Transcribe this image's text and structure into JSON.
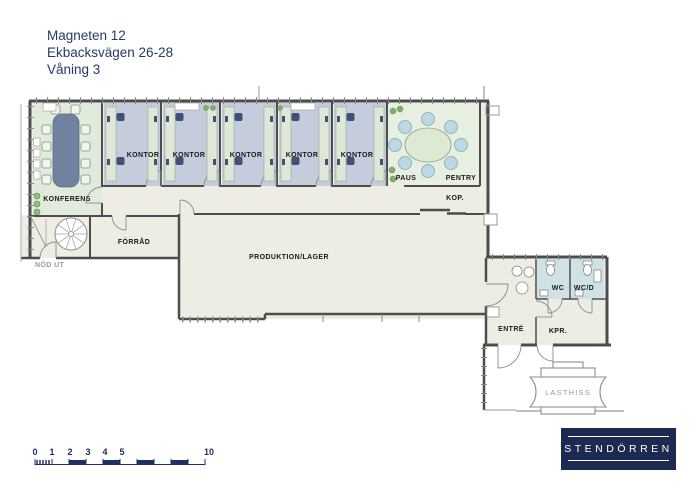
{
  "header": {
    "building": "Magneten 12",
    "address": "Ekbacksvägen 26-28",
    "floor": "Våning 3"
  },
  "rooms": {
    "konferens": "KONFERENS",
    "kontor": "KONTOR",
    "paus": "PAUS",
    "pentry": "PENTRY",
    "kop": "KOP.",
    "forrad": "FÖRRÅD",
    "produktion": "PRODUKTION/LAGER",
    "nod_ut": "NÖD UT",
    "wc": "WC",
    "wcd": "WC/D",
    "entre": "ENTRÉ",
    "kpr": "KPR.",
    "lasthiss": "LASTHISS"
  },
  "scalebar": {
    "labels": [
      "0",
      "1",
      "2",
      "3",
      "4",
      "5",
      "10"
    ]
  },
  "logo": {
    "text": "STENDÖRREN"
  },
  "colors": {
    "brand_navy": "#1c2a52",
    "scalebar_navy": "#1d3260",
    "title_blue": "#263a66",
    "wall_gray": "#4d4d4d",
    "floor_beige": "#eeede4",
    "office_blue": "#c5ccdb",
    "conference_green": "#e0ebdc",
    "paus_green": "#e7efe0",
    "wc_cyan": "#cfe3e6",
    "label_gray": "#9a9a9a"
  }
}
